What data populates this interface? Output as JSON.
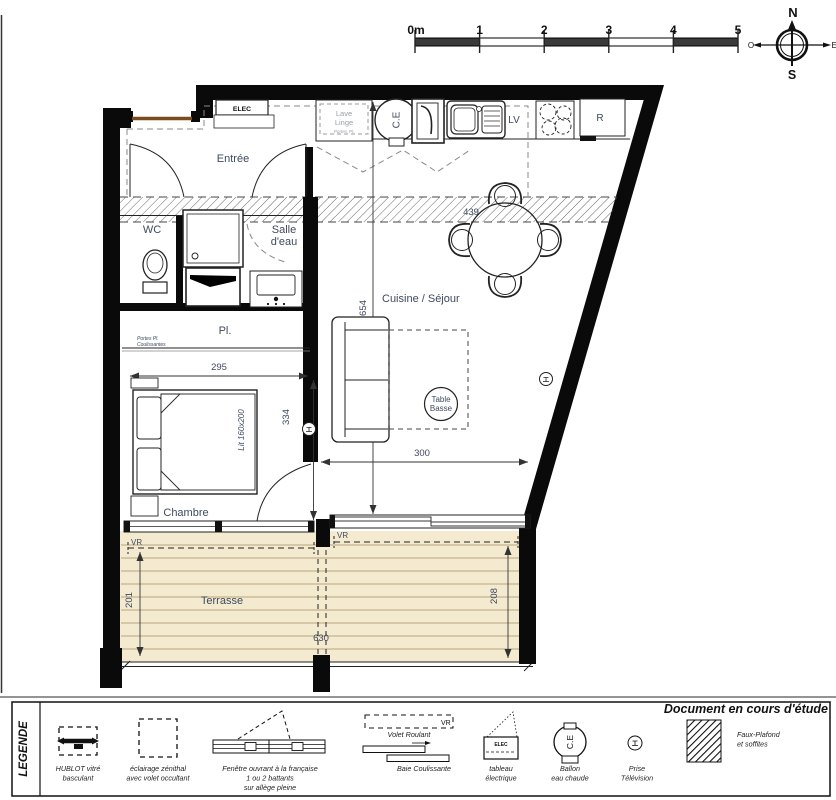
{
  "scale_bar": {
    "ticks": [
      "0m",
      "1",
      "2",
      "3",
      "4",
      "5"
    ]
  },
  "compass": {
    "north": "N",
    "south": "S",
    "west": "O",
    "east": "E"
  },
  "rooms": {
    "entree": "Entrée",
    "wc": "WC",
    "salle_eau_1": "Salle",
    "salle_eau_2": "d'eau",
    "cuisine_sejour": "Cuisine / Séjour",
    "placard": "Pl.",
    "chambre": "Chambre",
    "terrasse": "Terrasse"
  },
  "kitchen": {
    "elec": "ELEC",
    "lave_1": "Lave",
    "lave_2": "Linge",
    "lave_note": "Portes Pl.",
    "ce": "C.E",
    "lv": "LV",
    "fridge": "R"
  },
  "furniture": {
    "bed": "Lit 160x200",
    "coffee_1": "Table",
    "coffee_2": "Basse",
    "closet_1": "Portes Pl.",
    "closet_2": "Coulissantes"
  },
  "dims": {
    "band": "439",
    "sejour_h": "654",
    "chambre_w": "295",
    "chambre_h": "334",
    "sejour_w": "300",
    "terrasse_left_h": "201",
    "terrasse_right_h": "208",
    "terrasse_w": "630",
    "vr_left": "VR",
    "vr_right": "VR"
  },
  "legend": {
    "title": "LEGENDE",
    "note": "Document en cours d'étude",
    "hublot_1": "HUBLOT vitré",
    "hublot_2": "basculant",
    "eclairage_1": "éclairage zénithal",
    "eclairage_2": "avec volet occultant",
    "fenetre_1": "Fenêtre ouvrant à la française",
    "fenetre_2": "1 ou 2 battants",
    "fenetre_3": "sur allège pleine",
    "baie_vr": "VR",
    "baie_caption": "Volet Roulant",
    "baie_label": "Baie Coulissante",
    "tableau_sym": "ELEC",
    "tableau_1": "tableau",
    "tableau_2": "électrique",
    "ballon_sym": "C.E",
    "ballon_1": "Ballon",
    "ballon_2": "eau chaude",
    "prise_1": "Prise",
    "prise_2": "Télévision",
    "faux_1": "Faux-Plafond",
    "faux_2": "et soffites"
  },
  "colors": {
    "wall": "#0a0a0a",
    "label": "#3e4a5f",
    "terrace_fill": "#f4ead0",
    "deck_line": "#c3b58e",
    "entry_door": "#7c4a1f"
  }
}
